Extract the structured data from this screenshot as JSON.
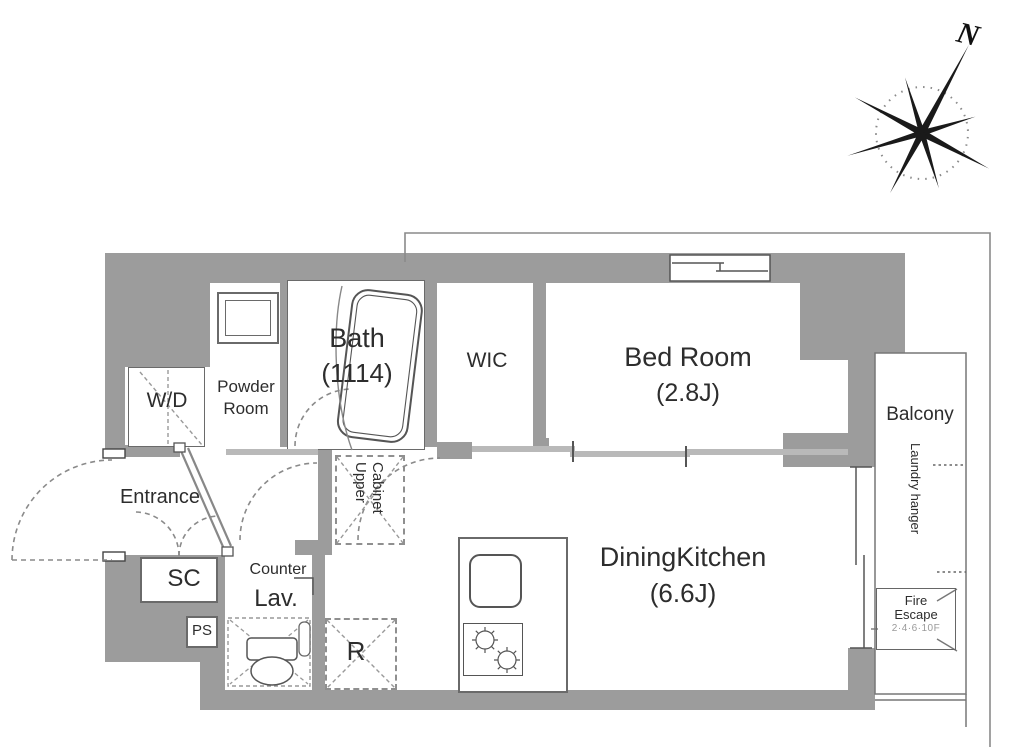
{
  "title": "apartment-floor-plan",
  "compass": {
    "north_label": "N"
  },
  "rooms": {
    "bath": {
      "name": "Bath",
      "size": "(1114)"
    },
    "powder_room": {
      "name_line1": "Powder",
      "name_line2": "Room"
    },
    "washer_dryer": {
      "name": "W/D"
    },
    "wic": {
      "name": "WIC"
    },
    "bedroom": {
      "name": "Bed Room",
      "size": "(2.8J)"
    },
    "entrance": {
      "name": "Entrance"
    },
    "shoe_closet": {
      "name": "SC"
    },
    "pipe_space": {
      "name": "PS"
    },
    "lavatory": {
      "counter_label": "Counter",
      "name": "Lav."
    },
    "upper_cabinet": {
      "line1": "Upper",
      "line2": "Cabinet"
    },
    "refrigerator": {
      "name": "R"
    },
    "dining_kitchen": {
      "name": "DiningKitchen",
      "size": "(6.6J)"
    },
    "balcony": {
      "name": "Balcony",
      "laundry_hanger": "Laundry hanger"
    },
    "fire_escape": {
      "line1": "Fire",
      "line2": "Escape",
      "line3": "2·4·6·10F"
    }
  },
  "colors": {
    "wall": "#9c9c9c",
    "slide_door": "#b9b9b9",
    "line": "#555555",
    "text": "#2d2d2d"
  }
}
